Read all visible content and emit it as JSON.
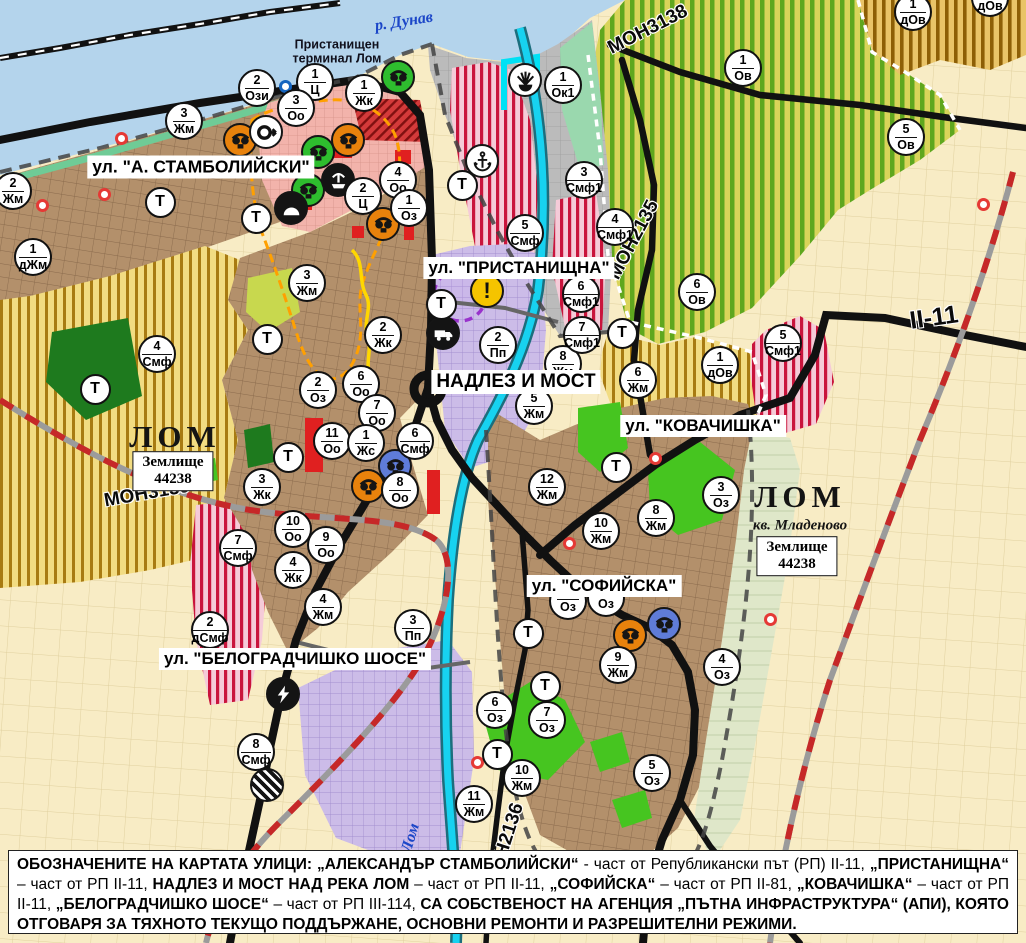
{
  "map": {
    "t_label": "Т",
    "street_labels": [
      {
        "text": "ул. \"А. СТАМБОЛИЙСКИ\"",
        "x": 201,
        "y": 167,
        "size": 17.5
      },
      {
        "text": "ул. \"ПРИСТАНИЩНА\"",
        "x": 519,
        "y": 268,
        "size": 17
      },
      {
        "text": "НАДЛЕЗ И МОСТ",
        "x": 516,
        "y": 382,
        "size": 19
      },
      {
        "text": "ул. \"КОВАЧИШКА\"",
        "x": 703,
        "y": 426,
        "size": 17
      },
      {
        "text": "ул. \"СОФИЙСКА\"",
        "x": 604,
        "y": 586,
        "size": 17
      },
      {
        "text": "ул. \"БЕЛОГРАДЧИШКО ШОСЕ\"",
        "x": 295,
        "y": 659,
        "size": 17
      }
    ],
    "road_labels": [
      {
        "text": "МОН3139",
        "x": 147,
        "y": 494,
        "rot": -10,
        "size": 19
      },
      {
        "text": "МОН3138",
        "x": 648,
        "y": 30,
        "rot": -27,
        "size": 19
      },
      {
        "text": "МОН2135",
        "x": 634,
        "y": 240,
        "rot": -62,
        "size": 19
      },
      {
        "text": "МОН2136",
        "x": 505,
        "y": 845,
        "rot": -72,
        "size": 19
      },
      {
        "text": "II-11",
        "x": 934,
        "y": 318,
        "rot": -8,
        "size": 25
      }
    ],
    "place_labels": [
      {
        "text": "р. Дунав",
        "x": 404,
        "y": 22,
        "rot": -9,
        "cls": "pl-river"
      },
      {
        "text": "Пристанищен\nтерминал Лом",
        "x": 337,
        "y": 52,
        "rot": 0,
        "cls": "pl-port"
      },
      {
        "text": "ЛОМ",
        "x": 175,
        "y": 437,
        "rot": 0,
        "cls": "pl-city"
      },
      {
        "text": "ЛОМ",
        "x": 800,
        "y": 497,
        "rot": 0,
        "cls": "pl-city"
      },
      {
        "text": "кв. Младеново",
        "x": 800,
        "y": 526,
        "rot": 0,
        "cls": "pl-sub"
      },
      {
        "text": "Лом",
        "x": 411,
        "y": 838,
        "rot": -73,
        "cls": "pl-river"
      }
    ],
    "land_boxes": [
      {
        "l1": "Землище",
        "l2": "44238",
        "x": 173,
        "y": 471
      },
      {
        "l1": "Землище",
        "l2": "44238",
        "x": 797,
        "y": 556
      }
    ],
    "markers": [
      {
        "n": "1",
        "c": "Ц",
        "x": 315,
        "y": 82
      },
      {
        "n": "1",
        "c": "Жк",
        "x": 364,
        "y": 93
      },
      {
        "n": "3",
        "c": "Оо",
        "x": 296,
        "y": 108
      },
      {
        "n": "2",
        "c": "Ози",
        "x": 257,
        "y": 88
      },
      {
        "n": "3",
        "c": "Жм",
        "x": 184,
        "y": 121
      },
      {
        "n": "2",
        "c": "Жм",
        "x": 13,
        "y": 191
      },
      {
        "n": "1",
        "c": "дЖм",
        "x": 33,
        "y": 257
      },
      {
        "n": "4",
        "c": "Оо",
        "x": 398,
        "y": 180
      },
      {
        "n": "2",
        "c": "Ц",
        "x": 363,
        "y": 196
      },
      {
        "n": "1",
        "c": "Оз",
        "x": 409,
        "y": 208
      },
      {
        "n": "3",
        "c": "Жм",
        "x": 307,
        "y": 283
      },
      {
        "n": "2",
        "c": "Жк",
        "x": 383,
        "y": 335
      },
      {
        "n": "4",
        "c": "Смф",
        "x": 157,
        "y": 354
      },
      {
        "n": "2",
        "c": "Оз",
        "x": 318,
        "y": 390
      },
      {
        "n": "6",
        "c": "Оо",
        "x": 361,
        "y": 384
      },
      {
        "n": "7",
        "c": "Оо",
        "x": 377,
        "y": 413
      },
      {
        "n": "11",
        "c": "Оо",
        "x": 332,
        "y": 441
      },
      {
        "n": "1",
        "c": "Жс",
        "x": 366,
        "y": 443
      },
      {
        "n": "6",
        "c": "Смф",
        "x": 415,
        "y": 441
      },
      {
        "n": "8",
        "c": "Оо",
        "x": 400,
        "y": 490
      },
      {
        "n": "3",
        "c": "Жк",
        "x": 262,
        "y": 487
      },
      {
        "n": "10",
        "c": "Оо",
        "x": 293,
        "y": 529
      },
      {
        "n": "9",
        "c": "Оо",
        "x": 326,
        "y": 545
      },
      {
        "n": "4",
        "c": "Жк",
        "x": 293,
        "y": 570
      },
      {
        "n": "4",
        "c": "Жм",
        "x": 323,
        "y": 607
      },
      {
        "n": "7",
        "c": "Смф",
        "x": 238,
        "y": 548
      },
      {
        "n": "2",
        "c": "дСмф",
        "x": 210,
        "y": 630
      },
      {
        "n": "3",
        "c": "Пп",
        "x": 413,
        "y": 628
      },
      {
        "n": "8",
        "c": "Смф",
        "x": 256,
        "y": 752
      },
      {
        "n": "2",
        "c": "Пп",
        "x": 498,
        "y": 345
      },
      {
        "n": "8",
        "c": "Жм",
        "x": 563,
        "y": 364
      },
      {
        "n": "5",
        "c": "Жм",
        "x": 534,
        "y": 406
      },
      {
        "n": "3",
        "c": "Смф1",
        "x": 584,
        "y": 180
      },
      {
        "n": "4",
        "c": "Смф1",
        "x": 615,
        "y": 227
      },
      {
        "n": "5",
        "c": "Смф",
        "x": 525,
        "y": 233
      },
      {
        "n": "6",
        "c": "Смф1",
        "x": 581,
        "y": 294
      },
      {
        "n": "7",
        "c": "Смф1",
        "x": 582,
        "y": 335
      },
      {
        "n": "6",
        "c": "Ов",
        "x": 697,
        "y": 292
      },
      {
        "n": "1",
        "c": "Ок1",
        "x": 563,
        "y": 85
      },
      {
        "n": "1",
        "c": "Ов",
        "x": 743,
        "y": 68
      },
      {
        "n": "5",
        "c": "Ов",
        "x": 906,
        "y": 137
      },
      {
        "n": "1",
        "c": "дОв",
        "x": 913,
        "y": 12
      },
      {
        "n": "1",
        "c": "дОв",
        "x": 990,
        "y": -2
      },
      {
        "n": "6",
        "c": "Жм",
        "x": 638,
        "y": 380
      },
      {
        "n": "1",
        "c": "дОв",
        "x": 720,
        "y": 365
      },
      {
        "n": "5",
        "c": "Смф1",
        "x": 783,
        "y": 343
      },
      {
        "n": "12",
        "c": "Жм",
        "x": 547,
        "y": 487
      },
      {
        "n": "10",
        "c": "Жм",
        "x": 601,
        "y": 531
      },
      {
        "n": "8",
        "c": "Жм",
        "x": 656,
        "y": 518
      },
      {
        "n": "3",
        "c": "Оз",
        "x": 721,
        "y": 495
      },
      {
        "n": "9",
        "c": "Жм",
        "x": 618,
        "y": 665
      },
      {
        "n": "4",
        "c": "Оз",
        "x": 722,
        "y": 667
      },
      {
        "n": "6",
        "c": "Оз",
        "x": 495,
        "y": 710
      },
      {
        "n": "7",
        "c": "Оз",
        "x": 547,
        "y": 720
      },
      {
        "n": "10",
        "c": "Жм",
        "x": 522,
        "y": 778
      },
      {
        "n": "11",
        "c": "Жм",
        "x": 474,
        "y": 804
      },
      {
        "n": "5",
        "c": "Оз",
        "x": 652,
        "y": 773
      },
      {
        "n": "",
        "c": "Оз",
        "x": 568,
        "y": 601,
        "partial": true
      },
      {
        "n": "",
        "c": "Оз",
        "x": 606,
        "y": 598,
        "partial": true
      }
    ],
    "t_markers": [
      {
        "x": 160,
        "y": 202
      },
      {
        "x": 256,
        "y": 218
      },
      {
        "x": 95,
        "y": 389
      },
      {
        "x": 267,
        "y": 339
      },
      {
        "x": 288,
        "y": 457
      },
      {
        "x": 441,
        "y": 304
      },
      {
        "x": 462,
        "y": 185
      },
      {
        "x": 622,
        "y": 333
      },
      {
        "x": 616,
        "y": 467
      },
      {
        "x": 528,
        "y": 633
      },
      {
        "x": 545,
        "y": 686
      },
      {
        "x": 497,
        "y": 754
      }
    ],
    "icons": [
      {
        "name": "landmark-icon",
        "bg": "green",
        "x": 398,
        "y": 77
      },
      {
        "name": "landmark-icon",
        "bg": "green",
        "x": 318,
        "y": 152
      },
      {
        "name": "landmark-icon",
        "bg": "green",
        "x": 308,
        "y": 190
      },
      {
        "name": "landmark-icon",
        "bg": "orange",
        "x": 240,
        "y": 140
      },
      {
        "name": "landmark-icon",
        "bg": "orange",
        "x": 348,
        "y": 140
      },
      {
        "name": "landmark-icon",
        "bg": "orange",
        "x": 383,
        "y": 224
      },
      {
        "name": "landmark-icon",
        "bg": "orange",
        "x": 368,
        "y": 486
      },
      {
        "name": "landmark-icon",
        "bg": "orange",
        "x": 630,
        "y": 635
      },
      {
        "name": "landmark-icon",
        "bg": "blue",
        "x": 395,
        "y": 466
      },
      {
        "name": "landmark-icon",
        "bg": "blue",
        "x": 664,
        "y": 624
      },
      {
        "name": "arrow-circle-icon",
        "bg": "white",
        "x": 266,
        "y": 132
      },
      {
        "name": "fountain-icon",
        "bg": "black",
        "x": 338,
        "y": 180
      },
      {
        "name": "cave-icon",
        "bg": "black",
        "x": 291,
        "y": 208
      },
      {
        "name": "beacon-icon",
        "bg": "white",
        "x": 525,
        "y": 80
      },
      {
        "name": "anchor-icon",
        "bg": "white",
        "x": 482,
        "y": 161
      },
      {
        "name": "warning-icon",
        "bg": "yellow",
        "x": 487,
        "y": 291
      },
      {
        "name": "truck-icon",
        "bg": "black",
        "x": 443,
        "y": 333
      },
      {
        "name": "lightning-icon",
        "bg": "black",
        "x": 283,
        "y": 694
      },
      {
        "name": "rail-crossing-icon",
        "bg": "striped",
        "x": 267,
        "y": 785
      }
    ],
    "dots": [
      {
        "color": "red",
        "x": 42,
        "y": 205
      },
      {
        "color": "red",
        "x": 104,
        "y": 194
      },
      {
        "color": "red",
        "x": 121,
        "y": 138
      },
      {
        "color": "red",
        "x": 655,
        "y": 458
      },
      {
        "color": "red",
        "x": 569,
        "y": 543
      },
      {
        "color": "red",
        "x": 477,
        "y": 762
      },
      {
        "color": "red",
        "x": 770,
        "y": 619
      },
      {
        "color": "red",
        "x": 983,
        "y": 204
      },
      {
        "color": "blue",
        "x": 285,
        "y": 86
      }
    ]
  },
  "caption": {
    "segments": [
      {
        "b": 1,
        "t": "ОБОЗНАЧЕНИТЕ НА КАРТАТА УЛИЦИ: „АЛЕКСАНДЪР СТАМБОЛИЙСКИ“"
      },
      {
        "b": 0,
        "t": " - част от Републикански път (РП) II-11, "
      },
      {
        "b": 1,
        "t": "„ПРИСТАНИЩНА“"
      },
      {
        "b": 0,
        "t": " – част от РП II-11, "
      },
      {
        "b": 1,
        "t": "НАДЛЕЗ И МОСТ НАД РЕКА ЛОМ"
      },
      {
        "b": 0,
        "t": " – част от РП II-11, "
      },
      {
        "b": 1,
        "t": "„СОФИЙСКА“"
      },
      {
        "b": 0,
        "t": " – част от РП II-81, "
      },
      {
        "b": 1,
        "t": "„КОВАЧИШКА“"
      },
      {
        "b": 0,
        "t": " – част от РП II-11, "
      },
      {
        "b": 1,
        "t": "„БЕЛОГРАДЧИШКО ШОСЕ“"
      },
      {
        "b": 0,
        "t": " – част от РП III-114, "
      },
      {
        "b": 1,
        "t": "СА СОБСТВЕНОСТ НА АГЕНЦИЯ „ПЪТНА ИНФРАСТРУКТУРА“ (АПИ), КОЯТО ОТГОВАРЯ ЗА ТЯХНОТО ТЕКУЩО ПОДДЪРЖАНЕ, ОСНОВНИ РЕМОНТИ И РАЗРЕШИТЕЛНИ РЕЖИМИ."
      }
    ]
  },
  "colors": {
    "water": "#B4D4EC",
    "road": "#111111",
    "rail_red": "#C62828",
    "icon_orange": "#E8820C",
    "icon_green": "#2EBD2E",
    "icon_blue": "#5F7CD8",
    "warning_yellow": "#F5C400",
    "marker_border": "#111111"
  }
}
